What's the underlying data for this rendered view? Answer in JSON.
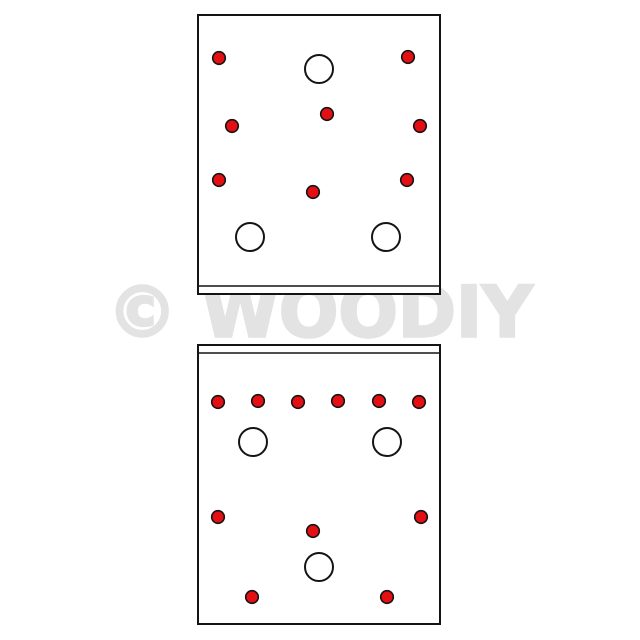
{
  "watermark": {
    "text": "© WOODIY",
    "color": "#e3e3e3"
  },
  "colors": {
    "background": "#ffffff",
    "plate_fill": "#ffffff",
    "outline": "#141414",
    "hole_fill": "#e30f12"
  },
  "diagram": {
    "small_hole_radius": 6.3,
    "small_hole_stroke": 1.6,
    "large_hole_radius": 14,
    "large_hole_stroke": 2,
    "plate_stroke": 2,
    "edge_line_stroke": 1.5,
    "panels": [
      {
        "name": "top-plate",
        "rect": {
          "x": 198,
          "y": 15,
          "width": 242,
          "height": 279
        },
        "edge_line_y": 286,
        "small_holes": [
          [
            219,
            58
          ],
          [
            408,
            57
          ],
          [
            327,
            114
          ],
          [
            232,
            126
          ],
          [
            420,
            126
          ],
          [
            219,
            180
          ],
          [
            407,
            180
          ],
          [
            313,
            192
          ]
        ],
        "large_holes": [
          [
            319,
            69
          ],
          [
            250,
            237
          ],
          [
            386,
            237
          ]
        ]
      },
      {
        "name": "bottom-plate",
        "rect": {
          "x": 198,
          "y": 345,
          "width": 242,
          "height": 279
        },
        "edge_line_y": 353,
        "small_holes": [
          [
            218,
            402
          ],
          [
            258,
            401
          ],
          [
            298,
            402
          ],
          [
            338,
            401
          ],
          [
            379,
            401
          ],
          [
            419,
            402
          ],
          [
            218,
            517
          ],
          [
            421,
            517
          ],
          [
            313,
            531
          ],
          [
            252,
            597
          ],
          [
            387,
            597
          ]
        ],
        "large_holes": [
          [
            253,
            442
          ],
          [
            387,
            442
          ],
          [
            319,
            567
          ]
        ]
      }
    ]
  }
}
